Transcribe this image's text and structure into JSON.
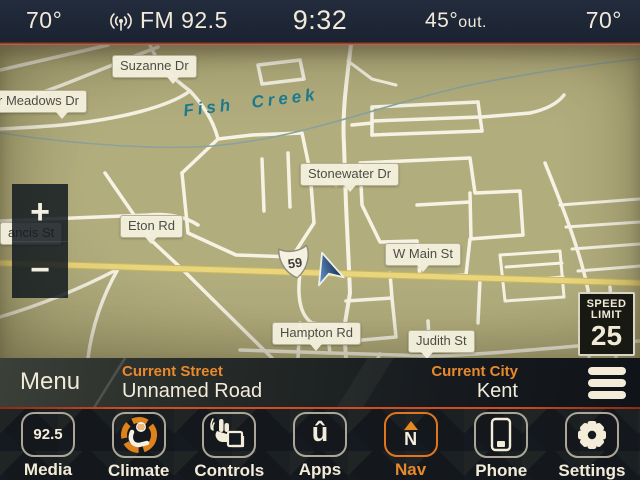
{
  "status_bar": {
    "driver_temp": "70°",
    "radio_icon": "broadcast-antenna",
    "station": "FM 92.5",
    "time": "9:32",
    "outside_temp": "45°",
    "outside_suffix": "out.",
    "passenger_temp": "70°"
  },
  "map": {
    "street_labels": {
      "suzanne": "Suzanne Dr",
      "meadows": "r Meadows Dr",
      "stonewater": "Stonewater Dr",
      "eton": "Eton Rd",
      "francis": "ancis St",
      "w_main": "W Main St",
      "hampton": "Hampton Rd",
      "judith": "Judith St"
    },
    "water_label": "Fish Creek",
    "route_shield": "59",
    "speed_limit_sign": {
      "line1": "SPEED",
      "line2": "LIMIT",
      "value": "25"
    },
    "zoom_in_label": "+",
    "zoom_out_label": "−"
  },
  "info_bar": {
    "menu_label": "Menu",
    "current_street_label": "Current Street",
    "current_street_value": "Unnamed Road",
    "current_city_label": "Current City",
    "current_city_value": "Kent"
  },
  "app_bar": {
    "items": [
      {
        "label": "Media",
        "icon": "radio-frequency-badge",
        "badge": "92.5"
      },
      {
        "label": "Climate",
        "icon": "climate-seat-fan-icon"
      },
      {
        "label": "Controls",
        "icon": "hand-controls-icon"
      },
      {
        "label": "Apps",
        "icon": "uconnect-apps-icon",
        "glyph": "û"
      },
      {
        "label": "Nav",
        "icon": "north-compass-icon",
        "letter": "N",
        "selected": true
      },
      {
        "label": "Phone",
        "icon": "smartphone-icon"
      },
      {
        "label": "Settings",
        "icon": "gear-icon"
      }
    ]
  },
  "colors": {
    "accent_orange": "#e8892c",
    "selected_outline": "#e2761c",
    "map_background": "#b2ad7d",
    "road_yellow": "#e9d67c",
    "creek_teal": "#1d7a8e",
    "separator_red": "#cf4d22",
    "status_bar_bg": "#1e2634"
  }
}
